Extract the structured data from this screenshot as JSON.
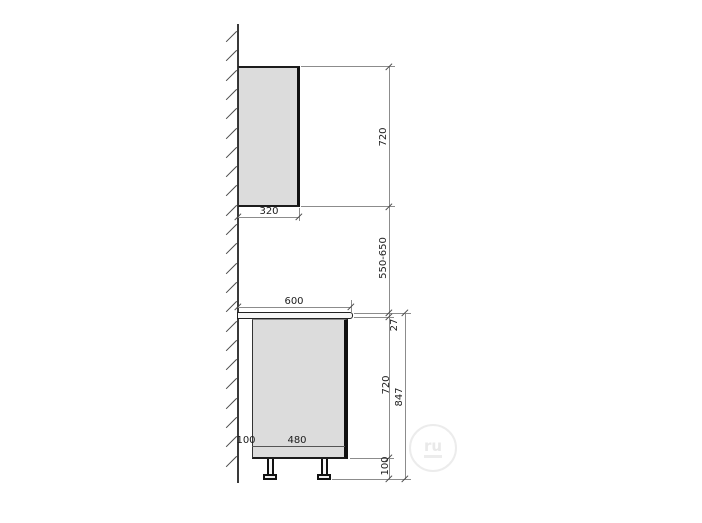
{
  "diagram": {
    "type": "kitchen-cabinet-side-elevation",
    "dimensions": {
      "upper_cabinet_height": "720",
      "upper_cabinet_depth": "320",
      "upper_to_counter_gap": "550-650",
      "countertop_depth": "600",
      "countertop_thickness": "27",
      "base_cabinet_height": "720",
      "total_base_height": "847",
      "leg_height": "100",
      "wall_back_gap": "100",
      "base_cabinet_depth": "480"
    },
    "watermark": {
      "badge_text": "ru"
    },
    "colors": {
      "cabinet_fill": "#dcdcdc",
      "countertop_fill": "#f6f6f6",
      "object_line": "#1c1c1c",
      "dimension_line": "#8c8c8c"
    }
  }
}
